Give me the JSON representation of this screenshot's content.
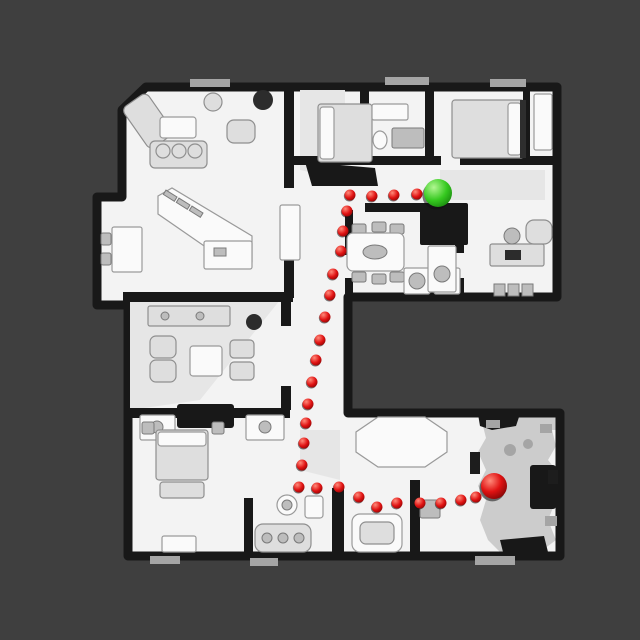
{
  "scene": {
    "description_name": "top-down-3d-house-scan-with-navigation-path",
    "background_color": "#3f3f3f",
    "floor_color": "#f3f3f3",
    "wall_color": "#181818",
    "furniture_color": "#dedede"
  },
  "navigation": {
    "waypoint_color": "#e01212",
    "waypoint_highlight": "#ff8a7a",
    "waypoint_rim": "#7e0404",
    "waypoint_radius": 5.5,
    "start_marker": {
      "label": "start",
      "color": "#35c91f",
      "highlight": "#b2f792",
      "rim": "#157c0c",
      "x": 438,
      "y": 193,
      "radius": 14
    },
    "goal_marker": {
      "label": "goal",
      "color": "#e01212",
      "highlight": "#ff8a7a",
      "rim": "#7e0404",
      "x": 494,
      "y": 486,
      "radius": 13
    },
    "waypoints": [
      [
        417,
        194
      ],
      [
        394,
        195
      ],
      [
        372,
        196
      ],
      [
        350,
        195
      ],
      [
        347,
        211
      ],
      [
        343,
        231
      ],
      [
        341,
        251
      ],
      [
        333,
        274
      ],
      [
        330,
        295
      ],
      [
        325,
        317
      ],
      [
        320,
        340
      ],
      [
        316,
        360
      ],
      [
        312,
        382
      ],
      [
        308,
        404
      ],
      [
        306,
        423
      ],
      [
        304,
        443
      ],
      [
        302,
        465
      ],
      [
        299,
        487
      ],
      [
        317,
        488
      ],
      [
        339,
        487
      ],
      [
        359,
        497
      ],
      [
        377,
        507
      ],
      [
        397,
        503
      ],
      [
        420,
        503
      ],
      [
        441,
        503
      ],
      [
        461,
        500
      ],
      [
        476,
        497
      ]
    ]
  }
}
